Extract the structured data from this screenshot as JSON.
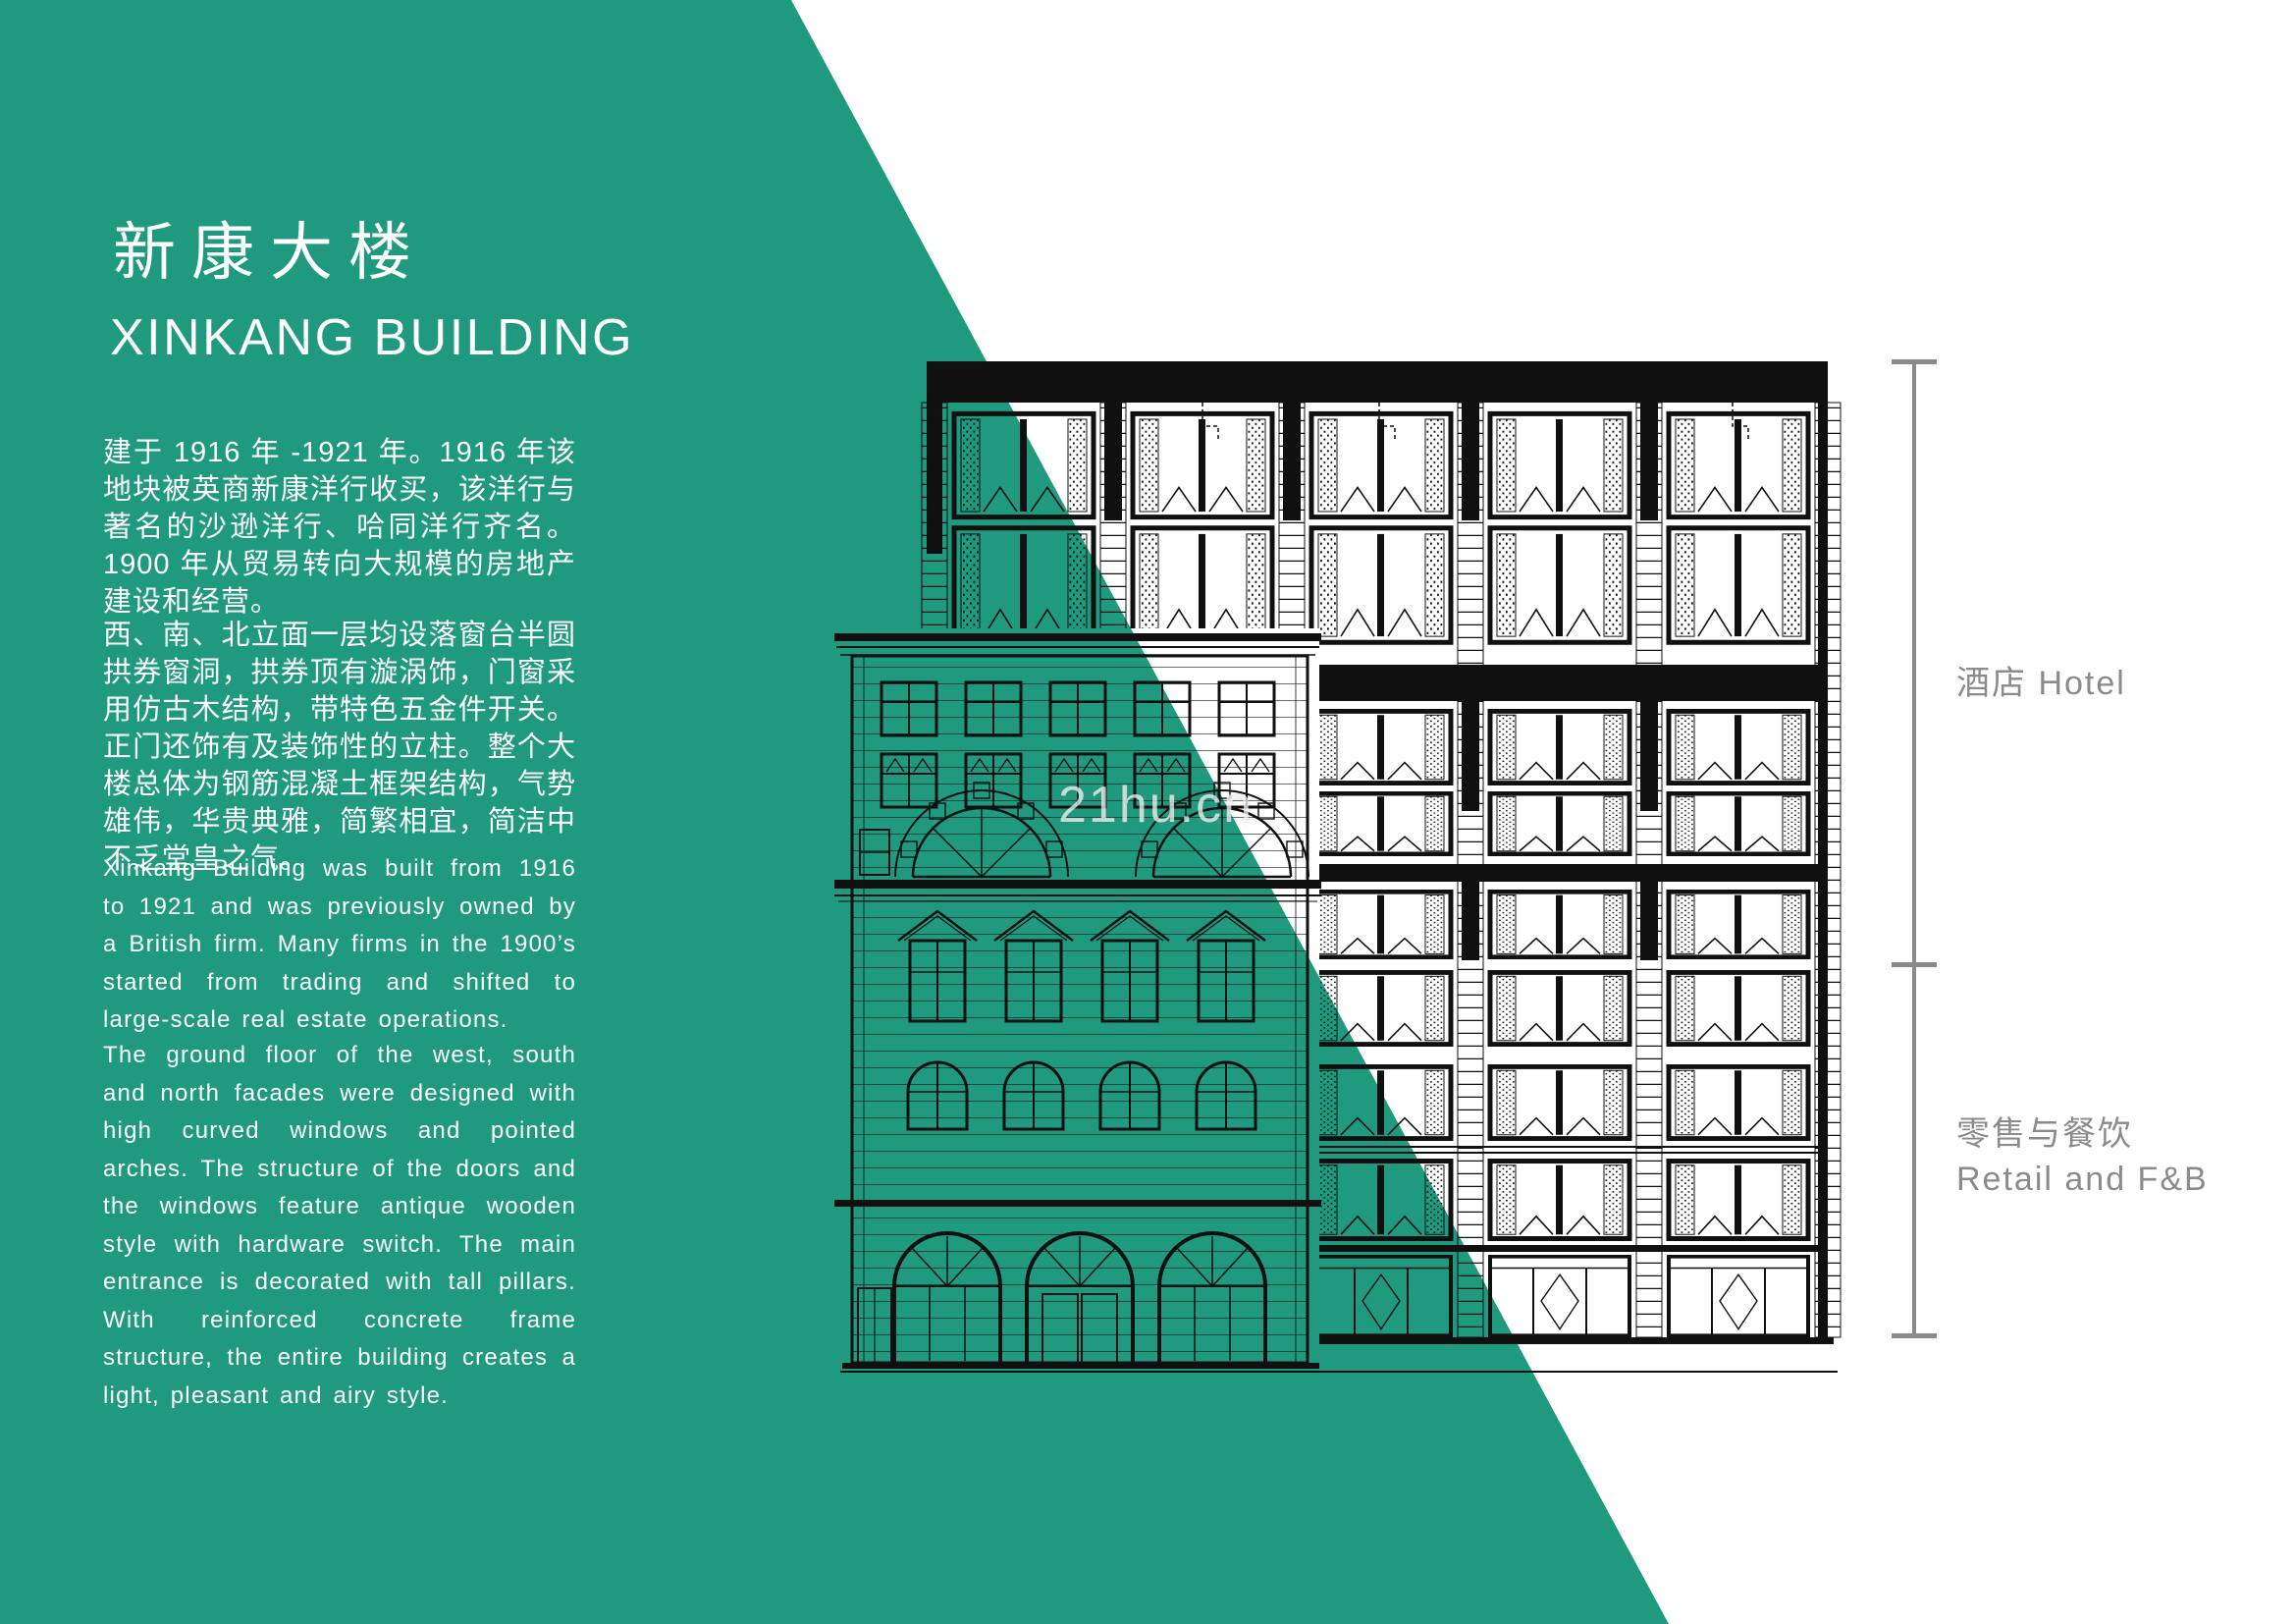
{
  "page": {
    "watermark": "21hu.cn",
    "background": "#ffffff",
    "accent_green": "#1f9a7e"
  },
  "header": {
    "title_zh": "新康大楼",
    "title_en": "XINKANG BUILDING"
  },
  "paragraphs": {
    "zh": [
      "建于 1916 年 -1921 年。1916 年该地块被英商新康洋行收买，该洋行与著名的沙逊洋行、哈同洋行齐名。1900 年从贸易转向大规模的房地产建设和经营。",
      "西、南、北立面一层均设落窗台半圆拱券窗洞，拱券顶有漩涡饰，门窗采用仿古木结构，带特色五金件开关。正门还饰有及装饰性的立柱。整个大楼总体为钢筋混凝土框架结构，气势雄伟，华贵典雅，简繁相宜，简洁中不乏堂皇之气。"
    ],
    "en": [
      "Xinkang Building was built from 1916 to 1921 and was previously owned by a British firm. Many firms in the 1900’s started from trading and shifted to large-scale real estate operations.",
      "The ground floor of the west, south and north facades were designed with high curved windows and pointed arches. The structure of the doors and the windows feature antique wooden style with hardware switch. The main entrance is decorated with tall pillars. With reinforced concrete frame structure, the entire building creates a light, pleasant and airy style."
    ]
  },
  "annotations": {
    "hotel": "酒店 Hotel",
    "retail_zh": "零售与餐饮",
    "retail_en": "Retail and F&B",
    "label_color": "#8b8b8b",
    "dimension_line_color": "#8a8a8a"
  },
  "drawing": {
    "ink_color": "#101010"
  }
}
